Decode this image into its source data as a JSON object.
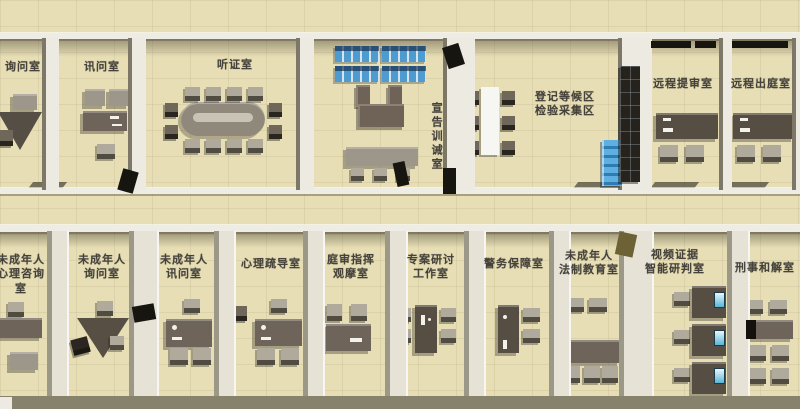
{
  "title": "检察院未成年人办案区三维平面布局图",
  "palette": {
    "floor": "#e7deb5",
    "wall": "#eceae1",
    "shadow": "#484330",
    "furniture_dark": "#574e43",
    "furniture": "#6e6459",
    "chair": "#b0aa9d",
    "seat_blue": "#4e9bd0",
    "cabinet_blue": "#3f93c8",
    "partition_dark": "#26231c",
    "label_text": "#45423c"
  },
  "floor_plan": {
    "top_rooms": [
      {
        "id": "inquiry-room",
        "label": "询问室"
      },
      {
        "id": "interrogation-room",
        "label": "讯问室"
      },
      {
        "id": "hearing-room",
        "label": "听证室"
      },
      {
        "id": "admonition-room",
        "label": "宣告训诫室",
        "orientation": "vertical"
      },
      {
        "id": "registration-waiting-area",
        "label": "登记等候区\n检验采集区"
      },
      {
        "id": "remote-arraignment-room",
        "label": "远程提审室"
      },
      {
        "id": "remote-court-appearance-room",
        "label": "远程出庭室"
      }
    ],
    "bottom_rooms": [
      {
        "id": "juvenile-psych-consult-room",
        "label": "未成年人\n心理咨询室"
      },
      {
        "id": "juvenile-inquiry-room",
        "label": "未成年人\n询问室"
      },
      {
        "id": "juvenile-interrogation-room",
        "label": "未成年人\n讯问室"
      },
      {
        "id": "psych-counseling-room",
        "label": "心理疏导室"
      },
      {
        "id": "trial-command-observation-room",
        "label": "庭审指挥\n观摩室"
      },
      {
        "id": "special-case-research-studio",
        "label": "专案研讨\n工作室"
      },
      {
        "id": "police-support-room",
        "label": "警务保障室"
      },
      {
        "id": "juvenile-legal-education-room",
        "label": "未成年人\n法制教育室"
      },
      {
        "id": "video-evidence-analysis-room",
        "label": "视频证据\n智能研判室"
      },
      {
        "id": "criminal-reconciliation-room",
        "label": "刑事和解室"
      }
    ]
  }
}
